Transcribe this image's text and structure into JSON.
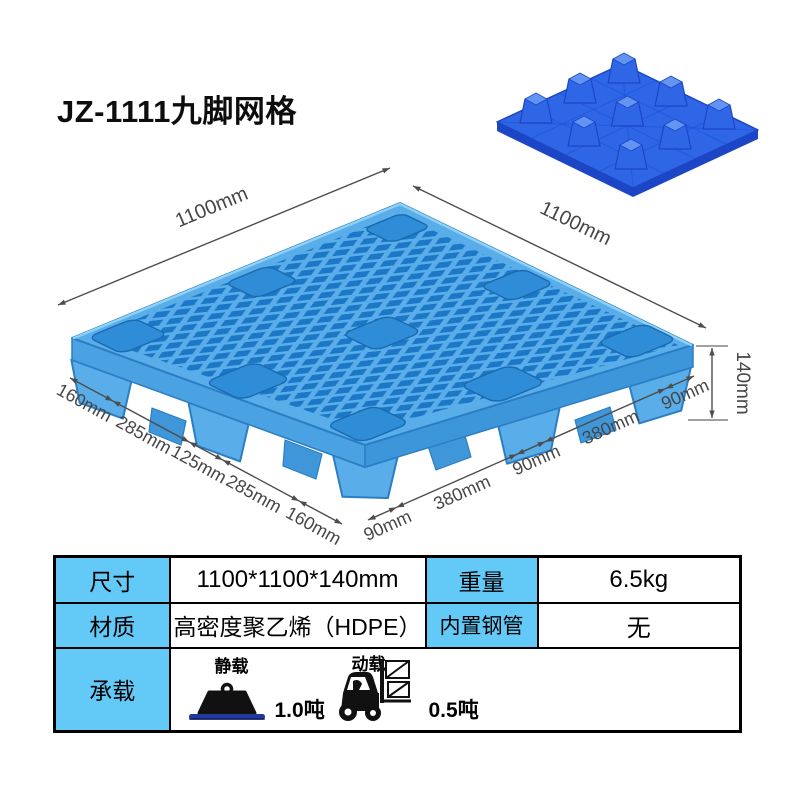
{
  "title": "JZ-1111九脚网格",
  "diagram": {
    "dim_width": "1100mm",
    "dim_depth": "1100mm",
    "dim_height": "140mm",
    "bottom_left_dims": [
      "160mm",
      "285mm",
      "125mm",
      "285mm",
      "160mm"
    ],
    "bottom_right_dims": [
      "90mm",
      "380mm",
      "90mm",
      "380mm",
      "90mm"
    ]
  },
  "spec_table": {
    "size_label": "尺寸",
    "size_value": "1100*1100*140mm",
    "weight_label": "重量",
    "weight_value": "6.5kg",
    "material_label": "材质",
    "material_value": "高密度聚乙烯（HDPE）",
    "steel_pipe_label": "内置钢管",
    "steel_pipe_value": "无",
    "load_label": "承载",
    "static_load_label": "静载",
    "static_load_value": "1.0吨",
    "dynamic_load_label": "动载",
    "dynamic_load_value": "0.5吨"
  },
  "colors": {
    "pallet-light": "#59ADE9",
    "pallet-hole": "#1C78C6",
    "pallet-cup": "#2F8CD6",
    "mini-deck": "#2E66E6",
    "mini-dark": "#1C46C6",
    "mini-light": "#6494F2",
    "table-header-bg": "#63C9F6",
    "dim-text": "#464646",
    "load-base-blue": "#223A9E"
  }
}
